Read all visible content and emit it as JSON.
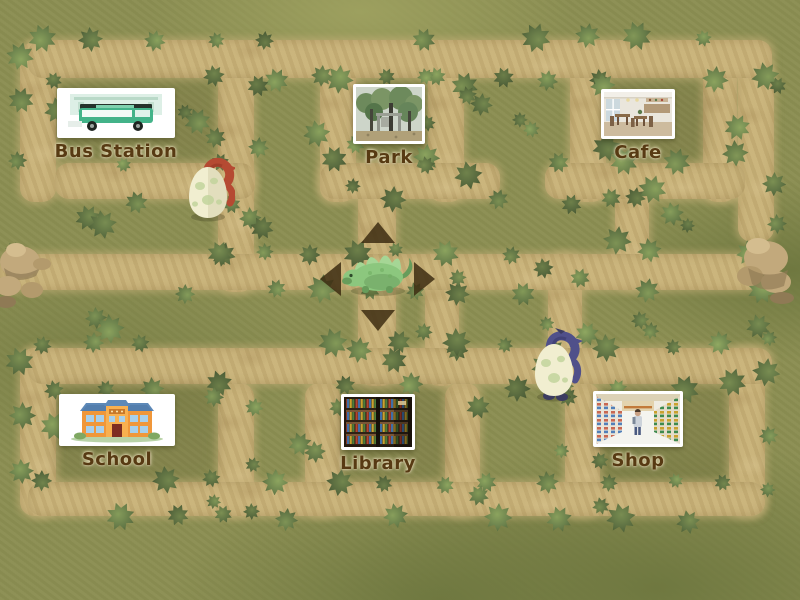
{
  "locations": [
    {
      "id": "bus-station",
      "label": "Bus Station"
    },
    {
      "id": "park",
      "label": "Park"
    },
    {
      "id": "cafe",
      "label": "Cafe"
    },
    {
      "id": "school",
      "label": "School"
    },
    {
      "id": "library",
      "label": "Library"
    },
    {
      "id": "shop",
      "label": "Shop"
    }
  ],
  "player": {
    "character": "green dinosaur",
    "available_moves": [
      "up",
      "left",
      "right",
      "down"
    ]
  },
  "hatchlings": [
    {
      "character": "red hatchling in spotted egg",
      "area": "upper-left corridor"
    },
    {
      "character": "purple hatchling in spotted egg",
      "area": "lower-right corridor"
    }
  ],
  "palette": {
    "grass": "#8b8e52",
    "grass_dark": "#6f7840",
    "grass_light": "#9da05f",
    "path": "#c7b178",
    "path_dark": "#b19a61",
    "bush": "#5f7344",
    "bush_dark": "#465630",
    "bush_light": "#7e9355",
    "label_text": "#573a13",
    "label_halo": "#f0e7c3",
    "arrow": "#3e2d12",
    "card_bg": "#ffffff",
    "egg_shell": "#f1eed0",
    "egg_spot": "#c2d49c",
    "red_hatchling": "#b54a32",
    "purple_hatchling": "#50508a",
    "player_green": "#8cc77e",
    "player_green_dark": "#679c5b",
    "rock": "#c2a97c",
    "rock_dark": "#8f7a55"
  }
}
